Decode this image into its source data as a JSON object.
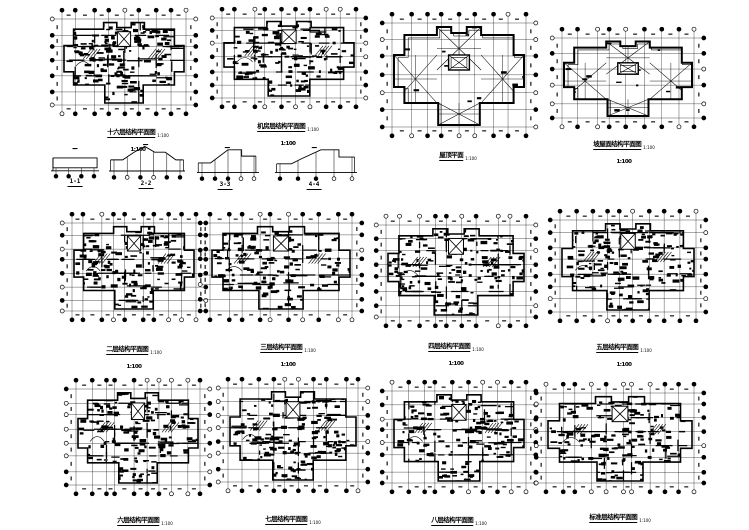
{
  "document": {
    "background": "#ffffff",
    "ink": "#000000",
    "kind": "structural-plan-sheet"
  },
  "plans": [
    {
      "id": "plan-1",
      "type": "dense",
      "box": {
        "x": 48,
        "y": 6,
        "w": 152,
        "h": 112
      },
      "grid": {
        "cols": 9,
        "rows": 7
      },
      "seed": 101,
      "title": {
        "text": "十六层结构平面图",
        "suffix": "1:100",
        "scale": "1:100",
        "two_line": true,
        "cx": 138,
        "y": 121
      }
    },
    {
      "id": "plan-2",
      "type": "dense",
      "box": {
        "x": 208,
        "y": 5,
        "w": 162,
        "h": 106
      },
      "grid": {
        "cols": 10,
        "rows": 7
      },
      "seed": 202,
      "title": {
        "text": "机房层结构平面图",
        "suffix": "1:100",
        "scale": "1:100",
        "two_line": true,
        "cx": 288,
        "y": 115
      }
    },
    {
      "id": "plan-3",
      "type": "roof",
      "box": {
        "x": 378,
        "y": 10,
        "w": 162,
        "h": 130
      },
      "grid": {
        "cols": 9,
        "rows": 7
      },
      "seed": 303,
      "title": {
        "text": "屋顶平面",
        "suffix": "1:100",
        "scale": "",
        "two_line": false,
        "cx": 458,
        "y": 144
      }
    },
    {
      "id": "plan-4",
      "type": "roof",
      "box": {
        "x": 548,
        "y": 25,
        "w": 160,
        "h": 106
      },
      "grid": {
        "cols": 9,
        "rows": 6
      },
      "seed": 404,
      "title": {
        "text": "坡屋面结构平面图",
        "suffix": "1:100",
        "scale": "1:100",
        "two_line": true,
        "cx": 624,
        "y": 133
      }
    },
    {
      "id": "plan-5",
      "type": "dense",
      "box": {
        "x": 58,
        "y": 210,
        "w": 152,
        "h": 114
      },
      "grid": {
        "cols": 10,
        "rows": 8
      },
      "seed": 505,
      "title": {
        "text": "二层结构平面图",
        "suffix": "1:100",
        "scale": "1:100",
        "two_line": true,
        "cx": 134,
        "y": 338
      }
    },
    {
      "id": "plan-6",
      "type": "dense",
      "box": {
        "x": 196,
        "y": 210,
        "w": 170,
        "h": 114
      },
      "grid": {
        "cols": 10,
        "rows": 8
      },
      "seed": 606,
      "title": {
        "text": "三层结构平面图",
        "suffix": "1:100",
        "scale": "1:100",
        "two_line": true,
        "cx": 288,
        "y": 336
      }
    },
    {
      "id": "plan-7",
      "type": "dense",
      "box": {
        "x": 372,
        "y": 212,
        "w": 168,
        "h": 118
      },
      "grid": {
        "cols": 10,
        "rows": 8
      },
      "seed": 707,
      "title": {
        "text": "四层结构平面图",
        "suffix": "1:100",
        "scale": "1:100",
        "two_line": true,
        "cx": 456,
        "y": 335
      }
    },
    {
      "id": "plan-8",
      "type": "dense",
      "box": {
        "x": 546,
        "y": 207,
        "w": 164,
        "h": 118
      },
      "grid": {
        "cols": 10,
        "rows": 8
      },
      "seed": 808,
      "title": {
        "text": "五层结构平面图",
        "suffix": "1:100",
        "scale": "1:100",
        "two_line": true,
        "cx": 624,
        "y": 336
      }
    },
    {
      "id": "plan-9",
      "type": "dense",
      "box": {
        "x": 62,
        "y": 376,
        "w": 152,
        "h": 122
      },
      "grid": {
        "cols": 10,
        "rows": 8
      },
      "seed": 909,
      "title": {
        "text": "六层结构平面图",
        "suffix": "1:100",
        "scale": "1:100",
        "two_line": true,
        "cx": 145,
        "y": 509
      }
    },
    {
      "id": "plan-10",
      "type": "dense",
      "box": {
        "x": 214,
        "y": 375,
        "w": 158,
        "h": 120
      },
      "grid": {
        "cols": 10,
        "rows": 8
      },
      "seed": 1010,
      "title": {
        "text": "七层结构平面图",
        "suffix": "1:100",
        "scale": "1:100",
        "two_line": true,
        "cx": 293,
        "y": 508
      }
    },
    {
      "id": "plan-11",
      "type": "dense",
      "box": {
        "x": 378,
        "y": 378,
        "w": 162,
        "h": 118
      },
      "grid": {
        "cols": 10,
        "rows": 8
      },
      "seed": 1111,
      "title": {
        "text": "八层结构平面图",
        "suffix": "1:100",
        "scale": "1:100",
        "two_line": true,
        "cx": 459,
        "y": 509
      }
    },
    {
      "id": "plan-12",
      "type": "dense",
      "box": {
        "x": 532,
        "y": 380,
        "w": 176,
        "h": 116
      },
      "grid": {
        "cols": 11,
        "rows": 8
      },
      "seed": 1212,
      "title": {
        "text": "标准层结构平面图",
        "suffix": "1:100",
        "scale": "1:100",
        "two_line": true,
        "cx": 620,
        "y": 506
      }
    }
  ],
  "sections": [
    {
      "id": "section-1",
      "label": "1-1",
      "profile": "box",
      "circles": 4,
      "box": {
        "x": 50,
        "y": 147,
        "w": 50,
        "h": 34
      },
      "label_cx": 75,
      "label_y": 178
    },
    {
      "id": "section-2",
      "label": "2-2",
      "profile": "hip",
      "circles": 6,
      "box": {
        "x": 108,
        "y": 143,
        "w": 78,
        "h": 40
      },
      "label_cx": 146,
      "label_y": 180
    },
    {
      "id": "section-3",
      "label": "3-3",
      "profile": "slope",
      "circles": 5,
      "box": {
        "x": 196,
        "y": 146,
        "w": 64,
        "h": 38
      },
      "label_cx": 225,
      "label_y": 181
    },
    {
      "id": "section-4",
      "label": "4-4",
      "profile": "slope2",
      "circles": 5,
      "box": {
        "x": 274,
        "y": 146,
        "w": 84,
        "h": 38
      },
      "label_cx": 314,
      "label_y": 181
    }
  ]
}
